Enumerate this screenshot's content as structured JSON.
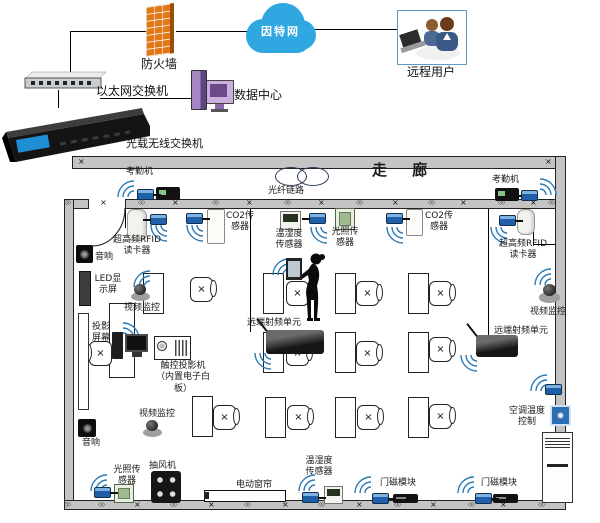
{
  "top": {
    "firewall_label": "防火墙",
    "internet_label": "因特网",
    "remote_user_label": "远程用户",
    "ethernet_switch_label": "以太网交换机",
    "data_center_label": "数据中心",
    "optical_switch_label": "光载无线交换机"
  },
  "corridor": {
    "corridor_label": "走  廊",
    "fiber_link_label": "光纤链路",
    "attendance_left_label": "考勤机",
    "attendance_right_label": "考勤机"
  },
  "room": {
    "rfid_left_label": "超高频RFID\n读卡器",
    "rfid_right_label": "超高频RFID\n读卡器",
    "co2_left_label": "CO2传\n感器",
    "co2_right_label": "CO2传\n感器",
    "temp_hum_top_label": "温湿度\n传感器",
    "temp_hum_bottom_label": "温湿度\n传感器",
    "light_top_label": "光照传\n感器",
    "light_bottom_label": "光照传\n感器",
    "speaker_top_label": "音响",
    "speaker_bottom_label": "音响",
    "led_label": "LED显\n示屏",
    "camera_top_label": "视频监控",
    "camera_bottom_label": "视频监控",
    "camera_right_label": "视频监控",
    "screen_label": "投影\n屏幕",
    "projector_label": "触控投影机\n（内置电子白\n板）",
    "rru_left_label": "远端射频单元",
    "rru_right_label": "远端射频单元",
    "fan_label": "抽风机",
    "curtain_label": "电动窗帘",
    "door_magnet_center_label": "门磁模块",
    "door_magnet_right_label": "门磁模块",
    "ac_label": "空调温度\n控制"
  },
  "colors": {
    "cloud_blue": "#2fa7e0",
    "transceiver_blue": "#1f5fa8",
    "firewall_orange": "#e07818",
    "wall_gray": "#c4c4c4"
  },
  "layout": {
    "desks": [
      [
        143,
        273
      ],
      [
        263,
        273
      ],
      [
        335,
        273
      ],
      [
        408,
        273
      ],
      [
        263,
        332
      ],
      [
        335,
        332
      ],
      [
        408,
        332
      ],
      [
        192,
        396
      ],
      [
        265,
        397
      ],
      [
        335,
        397
      ],
      [
        408,
        397
      ]
    ],
    "chairs": [
      [
        190,
        277,
        0
      ],
      [
        286,
        281,
        0
      ],
      [
        356,
        281,
        0
      ],
      [
        429,
        281,
        0
      ],
      [
        286,
        341,
        0
      ],
      [
        356,
        341,
        0
      ],
      [
        429,
        337,
        0
      ],
      [
        213,
        405,
        0
      ],
      [
        287,
        405,
        0
      ],
      [
        357,
        405,
        0
      ],
      [
        429,
        404,
        0
      ],
      [
        89,
        341,
        1
      ]
    ],
    "trx": [
      [
        137,
        189,
        1
      ],
      [
        521,
        190,
        -1
      ],
      [
        150,
        214,
        -1
      ],
      [
        186,
        213,
        1
      ],
      [
        309,
        213,
        -1
      ],
      [
        386,
        213,
        1
      ],
      [
        499,
        215,
        1
      ],
      [
        94,
        487,
        1
      ],
      [
        302,
        492,
        1
      ],
      [
        372,
        493,
        1
      ],
      [
        475,
        493,
        1
      ],
      [
        545,
        384,
        0
      ]
    ],
    "wifi": [
      [
        115,
        178,
        0
      ],
      [
        539,
        176,
        90
      ],
      [
        148,
        224,
        270
      ],
      [
        184,
        224,
        270
      ],
      [
        308,
        226,
        270
      ],
      [
        384,
        226,
        270
      ],
      [
        488,
        226,
        270
      ],
      [
        131,
        268,
        0
      ],
      [
        122,
        320,
        90
      ],
      [
        270,
        256,
        0
      ],
      [
        252,
        352,
        270
      ],
      [
        458,
        354,
        270
      ],
      [
        532,
        266,
        0
      ],
      [
        528,
        372,
        0
      ],
      [
        88,
        472,
        0
      ],
      [
        296,
        472,
        0
      ],
      [
        352,
        474,
        0
      ],
      [
        455,
        474,
        0
      ]
    ],
    "lines": [
      [
        70,
        31,
        76,
        1
      ],
      [
        176,
        31,
        77,
        1
      ],
      [
        312,
        29,
        86,
        1
      ],
      [
        70,
        31,
        1,
        41
      ],
      [
        58,
        90,
        1,
        18
      ],
      [
        100,
        98,
        92,
        1
      ],
      [
        250,
        208,
        1,
        124
      ],
      [
        488,
        208,
        1,
        129
      ],
      [
        533,
        230,
        1,
        15
      ],
      [
        533,
        244,
        23,
        1
      ],
      [
        557,
        390,
        1,
        45
      ],
      [
        125,
        208,
        1,
        20
      ]
    ],
    "marks_cross": [
      [
        100,
        199
      ],
      [
        172,
        199
      ],
      [
        246,
        199
      ],
      [
        318,
        199
      ],
      [
        392,
        199
      ],
      [
        460,
        199
      ],
      [
        530,
        199
      ],
      [
        134,
        501
      ],
      [
        208,
        501
      ],
      [
        282,
        501
      ],
      [
        356,
        501
      ],
      [
        430,
        501
      ],
      [
        500,
        501
      ],
      [
        78,
        158
      ],
      [
        545,
        158
      ]
    ],
    "marks_diamond": [
      [
        138,
        200
      ],
      [
        212,
        200
      ],
      [
        284,
        200
      ],
      [
        356,
        200
      ],
      [
        428,
        200
      ],
      [
        498,
        200
      ],
      [
        548,
        200
      ],
      [
        98,
        502
      ],
      [
        170,
        502
      ],
      [
        244,
        502
      ],
      [
        318,
        502
      ],
      [
        394,
        502
      ],
      [
        468,
        502
      ],
      [
        538,
        502
      ],
      [
        64,
        200
      ],
      [
        64,
        502
      ]
    ]
  }
}
